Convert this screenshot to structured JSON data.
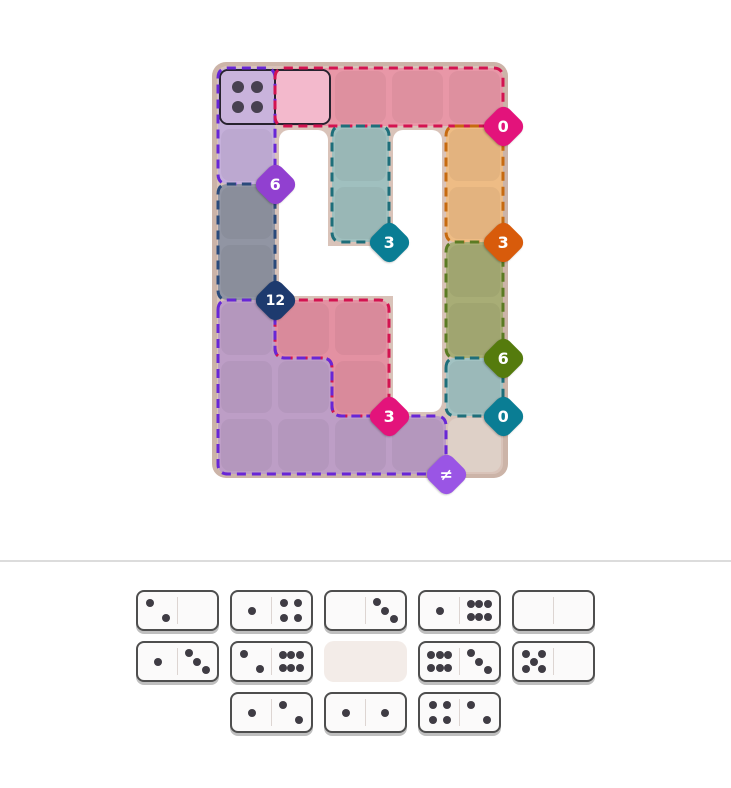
{
  "page": {
    "background": "#ffffff"
  },
  "board": {
    "x": 212,
    "y": 62,
    "width": 296,
    "height": 416,
    "surface_color": "#d9c3b9",
    "frame_color": "#ccb4a8",
    "hole_color": "#ffffff",
    "cell_tile_overlay": "rgba(0,0,0,0.045)",
    "grid": {
      "cols": 5,
      "rows": 7,
      "origin_x": 6,
      "origin_y": 6,
      "cell_w": 57,
      "cell_h": 58
    },
    "holes": [
      {
        "cells": [
          1,
          1,
          2,
          4
        ]
      },
      {
        "cells": [
          1,
          3,
          4,
          4
        ]
      },
      {
        "cells": [
          3,
          1,
          4,
          6
        ]
      }
    ],
    "plain_cells": [
      {
        "col": 4,
        "row": 6,
        "fill": "#ded0c7"
      }
    ],
    "regions": [
      {
        "id": "purple-top",
        "fill": "#c5b0da",
        "stroke": "#6826d6",
        "outline": [
          [
            0,
            0
          ],
          [
            1,
            0
          ],
          [
            1,
            2
          ],
          [
            0,
            2
          ]
        ],
        "cells": [
          [
            0,
            0
          ],
          [
            0,
            1
          ]
        ],
        "badge": {
          "value": "6",
          "color": "#9140d0",
          "anchor": [
            1,
            2
          ]
        }
      },
      {
        "id": "red-top",
        "fill": "#e897a7",
        "stroke": "#d31350",
        "outline": [
          [
            1,
            0
          ],
          [
            5,
            0
          ],
          [
            5,
            1
          ],
          [
            1,
            1
          ]
        ],
        "cells": [
          [
            1,
            0
          ],
          [
            2,
            0
          ],
          [
            3,
            0
          ],
          [
            4,
            0
          ]
        ],
        "badge": {
          "value": "0",
          "color": "#e3137b",
          "anchor": [
            5,
            1
          ]
        }
      },
      {
        "id": "teal-middle",
        "fill": "#a0c0bf",
        "stroke": "#1e6e7a",
        "outline": [
          [
            2,
            1
          ],
          [
            3,
            1
          ],
          [
            3,
            3
          ],
          [
            2,
            3
          ]
        ],
        "cells": [
          [
            2,
            1
          ],
          [
            2,
            2
          ]
        ],
        "badge": {
          "value": "3",
          "color": "#0a7d94",
          "anchor": [
            3,
            3
          ]
        }
      },
      {
        "id": "orange-right",
        "fill": "#eebc85",
        "stroke": "#c76a10",
        "outline": [
          [
            4,
            1
          ],
          [
            5,
            1
          ],
          [
            5,
            3
          ],
          [
            4,
            3
          ]
        ],
        "cells": [
          [
            4,
            1
          ],
          [
            4,
            2
          ]
        ],
        "badge": {
          "value": "3",
          "color": "#d85b0b",
          "anchor": [
            5,
            3
          ]
        }
      },
      {
        "id": "slate-left",
        "fill": "#9195a3",
        "stroke": "#2a4a7b",
        "outline": [
          [
            0,
            2
          ],
          [
            1,
            2
          ],
          [
            1,
            4
          ],
          [
            0,
            4
          ]
        ],
        "cells": [
          [
            0,
            2
          ],
          [
            0,
            3
          ]
        ],
        "badge": {
          "value": "12",
          "color": "#1d3a6e",
          "anchor": [
            1,
            4
          ]
        }
      },
      {
        "id": "green-right",
        "fill": "#a8ad76",
        "stroke": "#5b7b23",
        "outline": [
          [
            4,
            3
          ],
          [
            5,
            3
          ],
          [
            5,
            5
          ],
          [
            4,
            5
          ]
        ],
        "cells": [
          [
            4,
            3
          ],
          [
            4,
            4
          ]
        ],
        "badge": {
          "value": "6",
          "color": "#557b0d",
          "anchor": [
            5,
            5
          ]
        }
      },
      {
        "id": "teal-small",
        "fill": "#a2c2c2",
        "stroke": "#1e6e7a",
        "outline": [
          [
            4,
            5
          ],
          [
            5,
            5
          ],
          [
            5,
            6
          ],
          [
            4,
            6
          ]
        ],
        "cells": [
          [
            4,
            5
          ]
        ],
        "badge": {
          "value": "0",
          "color": "#0a7d94",
          "anchor": [
            5,
            6
          ]
        }
      },
      {
        "id": "red-lower",
        "fill": "#e391a2",
        "stroke": "#d31350",
        "outline": [
          [
            1,
            4
          ],
          [
            3,
            4
          ],
          [
            3,
            6
          ],
          [
            2,
            6
          ],
          [
            2,
            5
          ],
          [
            1,
            5
          ]
        ],
        "cells": [
          [
            1,
            4
          ],
          [
            2,
            4
          ],
          [
            2,
            5
          ]
        ],
        "badge": {
          "value": "3",
          "color": "#e3137b",
          "anchor": [
            3,
            6
          ]
        }
      },
      {
        "id": "purple-bottom",
        "fill": "#bd9ec6",
        "stroke": "#6826d6",
        "outline": [
          [
            0,
            4
          ],
          [
            1,
            4
          ],
          [
            1,
            5
          ],
          [
            2,
            5
          ],
          [
            2,
            6
          ],
          [
            4,
            6
          ],
          [
            4,
            7
          ],
          [
            0,
            7
          ]
        ],
        "cells": [
          [
            0,
            4
          ],
          [
            0,
            5
          ],
          [
            1,
            5
          ],
          [
            0,
            6
          ],
          [
            1,
            6
          ],
          [
            2,
            6
          ],
          [
            3,
            6
          ]
        ],
        "badge": {
          "value": "≠",
          "color": "#9a55e5",
          "anchor": [
            4,
            7
          ]
        }
      }
    ],
    "placed_domino": {
      "cells": [
        [
          0,
          0
        ],
        [
          1,
          0
        ]
      ],
      "values": [
        4,
        0
      ],
      "left_fill": "#c9b3dc",
      "right_fill": "#f3b9cc",
      "pip_color": "#474050"
    }
  },
  "divider": {
    "color": "#dcdcdc"
  },
  "tray": {
    "domino_style": {
      "body": "#fbfafa",
      "border": "#4e4e4e",
      "pip_color": "#3f3c44",
      "divider": "#ddd5d2",
      "empty_slot_color": "#f3ece8"
    },
    "rows": [
      [
        [
          2,
          0
        ],
        [
          1,
          4
        ],
        [
          0,
          3
        ],
        [
          1,
          6
        ],
        [
          0,
          0
        ]
      ],
      [
        [
          1,
          3
        ],
        [
          2,
          6
        ],
        null,
        [
          6,
          3
        ],
        [
          5,
          0
        ]
      ],
      [
        [
          1,
          2
        ],
        [
          1,
          1
        ],
        [
          4,
          2
        ]
      ]
    ]
  }
}
